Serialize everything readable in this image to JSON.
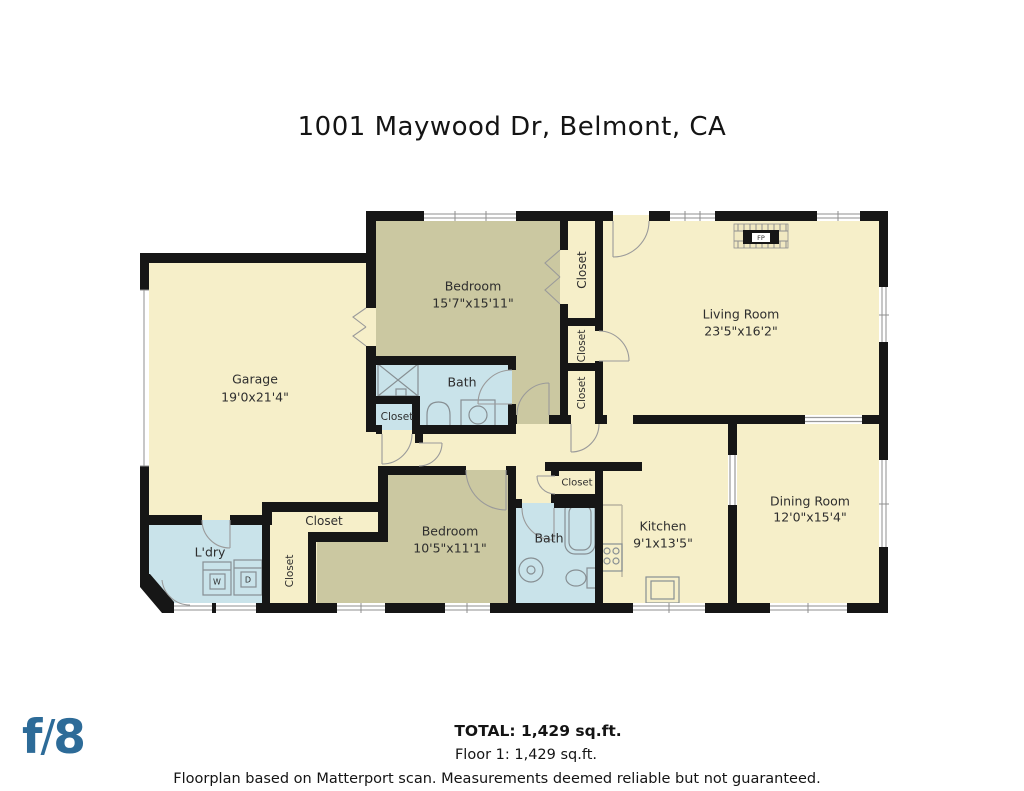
{
  "title": "1001 Maywood Dr, Belmont, CA",
  "rooms": {
    "garage": {
      "name": "Garage",
      "dims": "19'0x21'4\""
    },
    "bedroom1": {
      "name": "Bedroom",
      "dims": "15'7\"x15'11\""
    },
    "living": {
      "name": "Living Room",
      "dims": "23'5\"x16'2\""
    },
    "dining": {
      "name": "Dining Room",
      "dims": "12'0\"x15'4\""
    },
    "kitchen": {
      "name": "Kitchen",
      "dims": "9'1x13'5\""
    },
    "bedroom2": {
      "name": "Bedroom",
      "dims": "10'5\"x11'1\""
    },
    "bath1": {
      "name": "Bath"
    },
    "bath2": {
      "name": "Bath"
    },
    "laundry": {
      "name": "L'dry"
    },
    "closet": {
      "name": "Closet"
    },
    "fireplace": {
      "abbr": "FP"
    },
    "washer": {
      "abbr": "W"
    },
    "dryer": {
      "abbr": "D"
    }
  },
  "footer": {
    "total": "TOTAL: 1,429 sq.ft.",
    "floor": "Floor 1: 1,429 sq.ft.",
    "disclaimer": "Floorplan based on Matterport scan. Measurements deemed reliable but not guaranteed."
  },
  "logo": {
    "f": "f",
    "slash": "/",
    "eight": "8"
  },
  "colors": {
    "wall": "#161616",
    "room_cream": "#f6efc9",
    "room_olive": "#cbc8a1",
    "room_blue": "#c9e3ea",
    "logo_blue": "#2d6b98",
    "text": "#2e2e2e"
  }
}
